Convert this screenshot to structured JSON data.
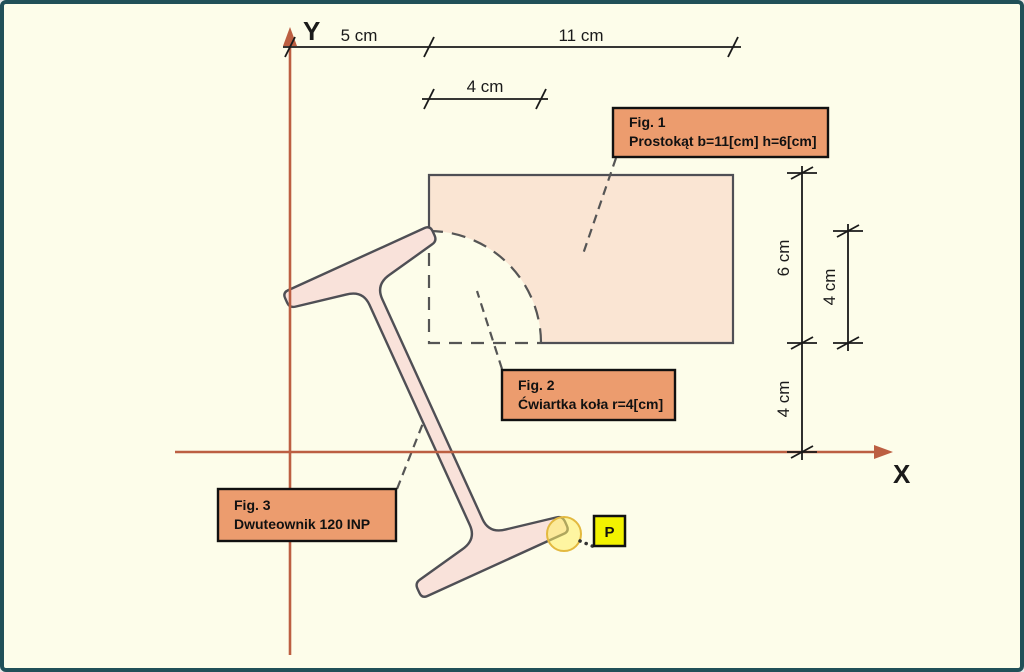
{
  "axes": {
    "x_label": "X",
    "y_label": "Y",
    "color": "#BC5F42"
  },
  "dimensions": {
    "offset_x": "5 cm",
    "rect_width": "11 cm",
    "radius_top": "4 cm",
    "rect_height": "6 cm",
    "radius_right": "4 cm",
    "offset_y": "4 cm"
  },
  "figure_labels": {
    "fig1": {
      "title": "Fig. 1",
      "description": "Prostokąt b=11[cm] h=6[cm]"
    },
    "fig2": {
      "title": "Fig. 2",
      "description": "Ćwiartka koła r=4[cm]"
    },
    "fig3": {
      "title": "Fig. 3",
      "description": "Dwuteownik 120 INP"
    }
  },
  "point_marker": {
    "label": "P"
  },
  "colors": {
    "background": "#FDFDEA",
    "frame_border": "#215058",
    "axis": "#BC5F42",
    "outline": "#4F4F55",
    "rect_fill": "#FAE5D3",
    "beam_fill": "#F9E2DA",
    "label_box_fill": "#EC9C6E",
    "point_box_fill": "#F2F200",
    "highlight_circle_fill": "#FFEE64",
    "highlight_circle_stroke": "#E3B93F"
  }
}
